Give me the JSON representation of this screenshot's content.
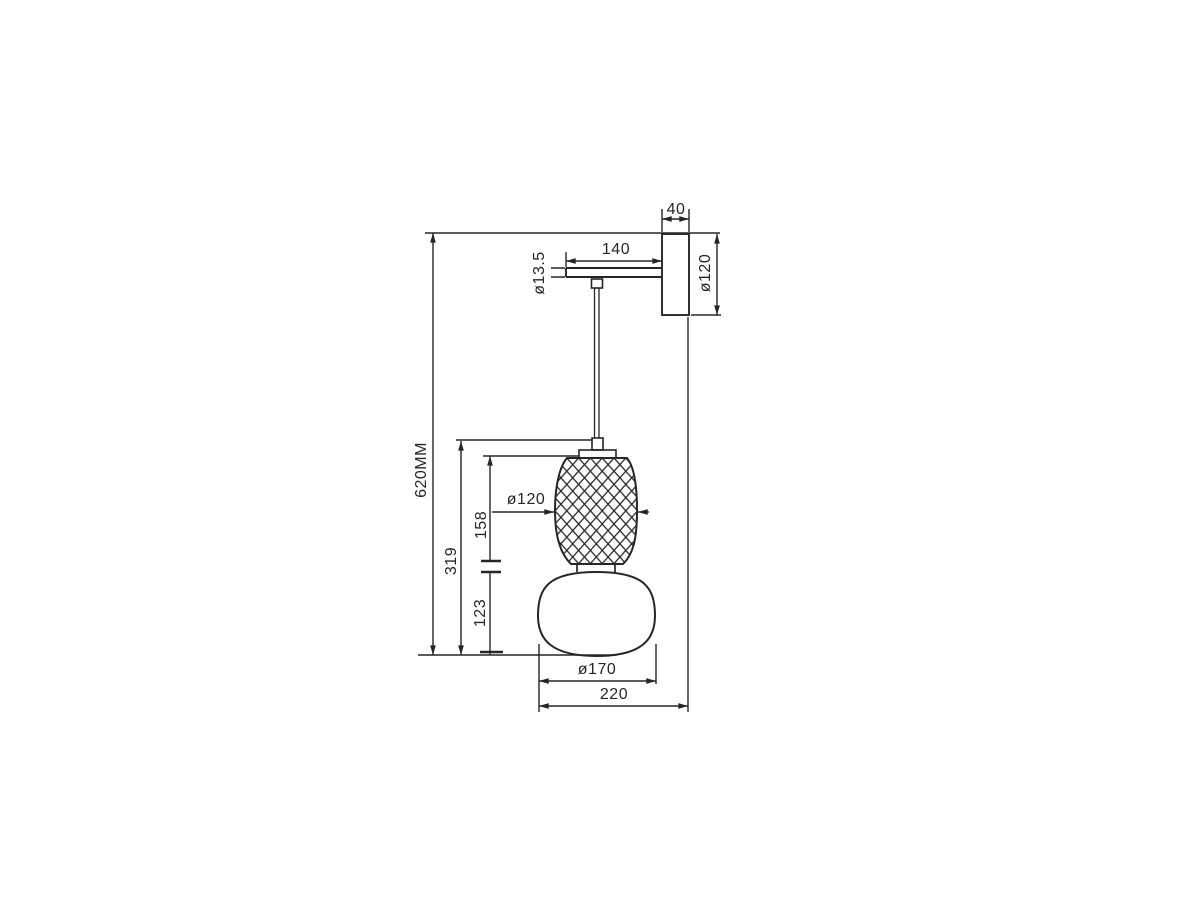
{
  "drawing": {
    "title": "Wall lamp dimensional drawing",
    "units": "MM",
    "colors": {
      "line": "#262626",
      "background": "#ffffff"
    },
    "dims": {
      "bracket_depth": "40",
      "arm_length": "140",
      "stem_diameter": "ø13.5",
      "backplate_size": "ø120",
      "overall_height": "620MM",
      "hanging_section_height": "319",
      "top_shade_height": "158",
      "top_shade_diameter": "ø120",
      "bottom_shade_height": "123",
      "bottom_shade_diameter": "ø170",
      "overall_projection": "220"
    }
  }
}
